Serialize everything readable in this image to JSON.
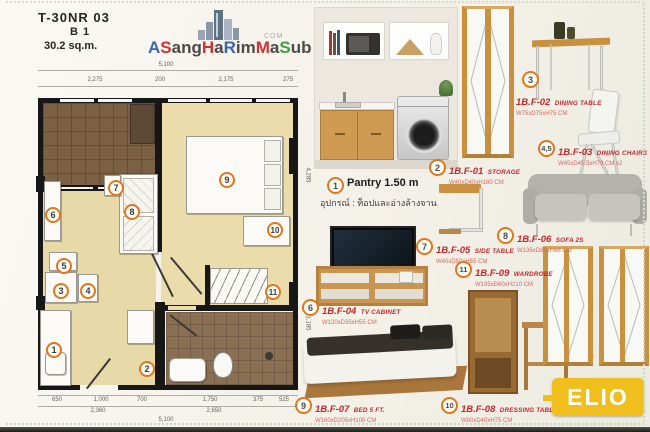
{
  "header": {
    "model": "T-30NR 03",
    "unit": "B 1",
    "area": "30.2 sq.m."
  },
  "logo": {
    "com": ".COM",
    "letters": [
      {
        "t": "A",
        "c": "#3a66b0"
      },
      {
        "t": "S",
        "c": "#cc3333"
      },
      {
        "t": "ang",
        "c": "#4a4a4a"
      },
      {
        "t": "H",
        "c": "#cc3333"
      },
      {
        "t": "a",
        "c": "#4a4a4a"
      },
      {
        "t": "R",
        "c": "#3a66b0"
      },
      {
        "t": "im",
        "c": "#4a4a4a"
      },
      {
        "t": "M",
        "c": "#cc3333"
      },
      {
        "t": "a",
        "c": "#4a4a4a"
      },
      {
        "t": "S",
        "c": "#3fa03f"
      },
      {
        "t": "ub",
        "c": "#4a4a4a"
      }
    ]
  },
  "plan": {
    "markers": [
      "1",
      "2",
      "3",
      "4",
      "5",
      "6",
      "7",
      "8",
      "9",
      "10",
      "11"
    ],
    "dims_top_total": "5,100",
    "dims_top": [
      "2,275",
      "200",
      "2,175",
      "275"
    ],
    "dims_bottom_row1": [
      "650",
      "1,000",
      "700",
      "1,750",
      "375",
      "525"
    ],
    "dims_bottom_row2": [
      "2,360",
      "2,650"
    ],
    "dims_bottom_total": "5,100",
    "dims_right": [
      "4,285",
      "1,185",
      "560"
    ]
  },
  "catalog": {
    "pantry": {
      "num": "1",
      "title": "Pantry 1.50 m",
      "note": "อุปกรณ์ : ท็อปและอ่างล้างจาน"
    },
    "items": [
      {
        "num": "2",
        "code": "1B.F-01",
        "name": "STORAGE",
        "dims": "W40xD40xH180 CM"
      },
      {
        "num": "3",
        "code": "1B.F-02",
        "name": "DINING TABLE",
        "dims": "W75xD75xH75 CM"
      },
      {
        "num": "4,5",
        "code": "1B.F-03",
        "name": "DINING CHAIRS",
        "dims": "W45xD45.5xH79 CM  x2"
      },
      {
        "num": "6",
        "code": "1B.F-04",
        "name": "TV CABINET",
        "dims": "W120xD35xH55 CM"
      },
      {
        "num": "7",
        "code": "1B.F-05",
        "name": "SIDE TABLE",
        "dims": "W40xD50xH55 CM"
      },
      {
        "num": "8",
        "code": "1B.F-06",
        "name": "SOFA 2S",
        "dims": "W135xD85xH88 CM"
      },
      {
        "num": "9",
        "code": "1B.F-07",
        "name": "BED 5 FT.",
        "dims": "W160xD205xH100 CM"
      },
      {
        "num": "10",
        "code": "1B.F-08",
        "name": "DRESSING TABLE",
        "dims": "W80xD40xH75 CM"
      },
      {
        "num": "11",
        "code": "1B.F-09",
        "name": "WARDROBE",
        "dims": "W135xD60xH210 CM"
      }
    ]
  },
  "brand": {
    "elio": "ELIO",
    "accent_orange": "#e0771c",
    "label_red": "#c1272d",
    "elio_yellow": "#f0bf1e"
  }
}
